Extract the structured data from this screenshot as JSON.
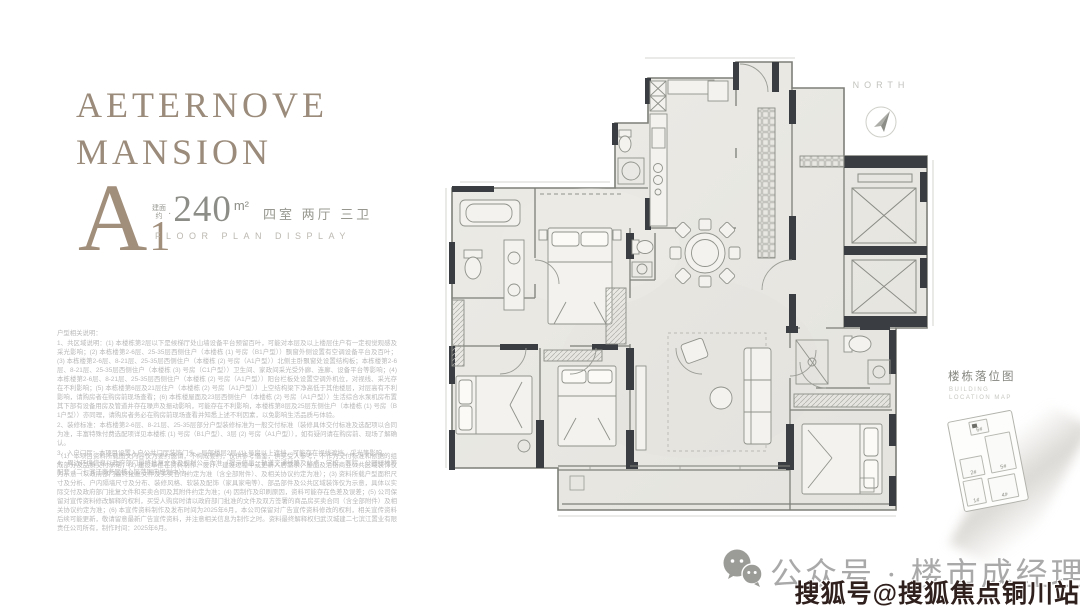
{
  "brand": {
    "line1": "AETERNOVE",
    "line2": "MANSION"
  },
  "unit": {
    "type_letter": "A",
    "type_number": "1",
    "area_prefix_top": "建面",
    "area_prefix_bottom": "约",
    "area_dot": "·",
    "area_value": "240",
    "area_unit": "m²",
    "layout": "四室  两厅  三卫",
    "subtitle": "FLOOR PLAN DISPLAY"
  },
  "disclaimer": {
    "intro": "户型相关说明：",
    "item1": "1、共区域说明：(1) 本楼栋第2层以下是候梯厅处山墙设备平台预留百叶，可能对本层及以上楼层住户有一定视觉观感及采光影响；(2) 本栋楼第2-6层、25-35层西侧住户（本楼栋 (1) 号房（B1户型））飘窗外侧设置有空调设备平台及百叶；(3) 本栋楼第2-6层、8-21层、25-35层西侧住户（本楼栋 (2) 号房（A1户型））北侧主卧飘窗处设置结构板；本栋楼第2-6层、8-21层、25-35层西侧住户（本楼栋 (3) 号房（C1户型））卫生间、家政间采光受外廊、连廊、设备平台等影响；(4) 本栋楼第2-6层、8-21层、25-35层西侧住户（本楼栋 (2) 号房（A1户型））阳台栏板处设置空调外机位，对视线、采光存在不利影响；(5) 本栋楼第6层及21层住户（本楼栋 (2) 号房（A1户型））上空结构梁下净高低于其他楼层，对层高有不利影响，请购房者在购房前现场查看；(6) 本栋楼屋面及23层西侧住户（本楼栋 (2) 号房（A1户型））生活综合水泵机房布置其下部有设备用房及管道井存在噪声及振动影响，可能存在不利影响，本楼栋第8层及25层东侧住户（本楼栋 (1) 号房（B1户型））亦同理，请购房者务必在购房前现场查看并知悉上述不利因素，以免影响生活品质与体验。",
    "item2": "2、装修标准：本栋楼第2-6层、8-21层、25-35层部分户型装修标准为一般交付标准（装修具体交付标准及选配项以合同为准，丰富特殊付费选配项详见本楼栋 (1) 号房（B1户型）、3层 (2) 号房（A1户型）），如有疑问请在购房前、现场了解确认。",
    "item3": "3、入户门厅：本项目设置入户公共门厅装饰门头，局部楼层2层 (1) 号房以上遮挡，可能存在视线遮挡、采光等影响。",
    "item4": "4、周边环境信息以政府部门最终批复文件及规划公示为准（提示信息：轨道交通线路及站点、学校、医院、公园绿地等配套（二七滨江商务区核心区范围内规划中））。",
    "para2": "（1）本项目资料所载图文内容仅为要约邀请，不构成要约，仅供参考借鉴，供买受人参考，不作为交付标准和依据的组成部分及品质交付承诺；(2) 建设单位在资料制作、设计、建设过程中或更新人居需求，屋面及沿街商业公共区域装饰仅为示意（以政府部门最终批复文件及买卖合同约定为准（含全部附件）、及相关协议约定为准）；(3) 资料所载户型面积尺寸及分析、户内隔墙尺寸及分布、装修风格、软装及配饰（家具家电等）、部品部件及公共区域装饰仅为示意，具体以实际交付及政府部门批复文件和买卖合同及其附件约定为准；(4) 因制作及印刷原因，资料可能存在色差及误差；(5) 公司保留对宣传资料修改解释的权利，买受人购房时请以政府部门批准的文件及双方签署的商品房买卖合同（含全部附件）及相关协议约定为准；(6) 本宣传资料制作及发布时间为2025年6月，本公司保留对广告宣传资料修改的权利，相关宣传资料后续可能更新，敬请留意最新广告宣传资料，并注意相关信息为制作之时。资料最终解释权归武汉城建二七滨江置业有限责任公司所有，制作时间：2025年6月。"
  },
  "compass": {
    "label": "NORTH"
  },
  "location_map": {
    "title": "楼栋落位图",
    "subtitle_line1": "BUILDING",
    "subtitle_line2": "LOCATION MAP",
    "buildings": [
      "6#",
      "5#",
      "2#",
      "1#",
      "4#"
    ]
  },
  "footer": {
    "account_label": "公众号 · 楼市成经理",
    "watermark": "搜狐号@搜狐焦点铜川站"
  },
  "colors": {
    "brand_taupe": "#9a8b7a",
    "wall_dark": "#3a3d42",
    "plan_paper": "#eae9e4",
    "watermark_ink": "#30201d",
    "footer_gray": "#a9a9a9"
  }
}
